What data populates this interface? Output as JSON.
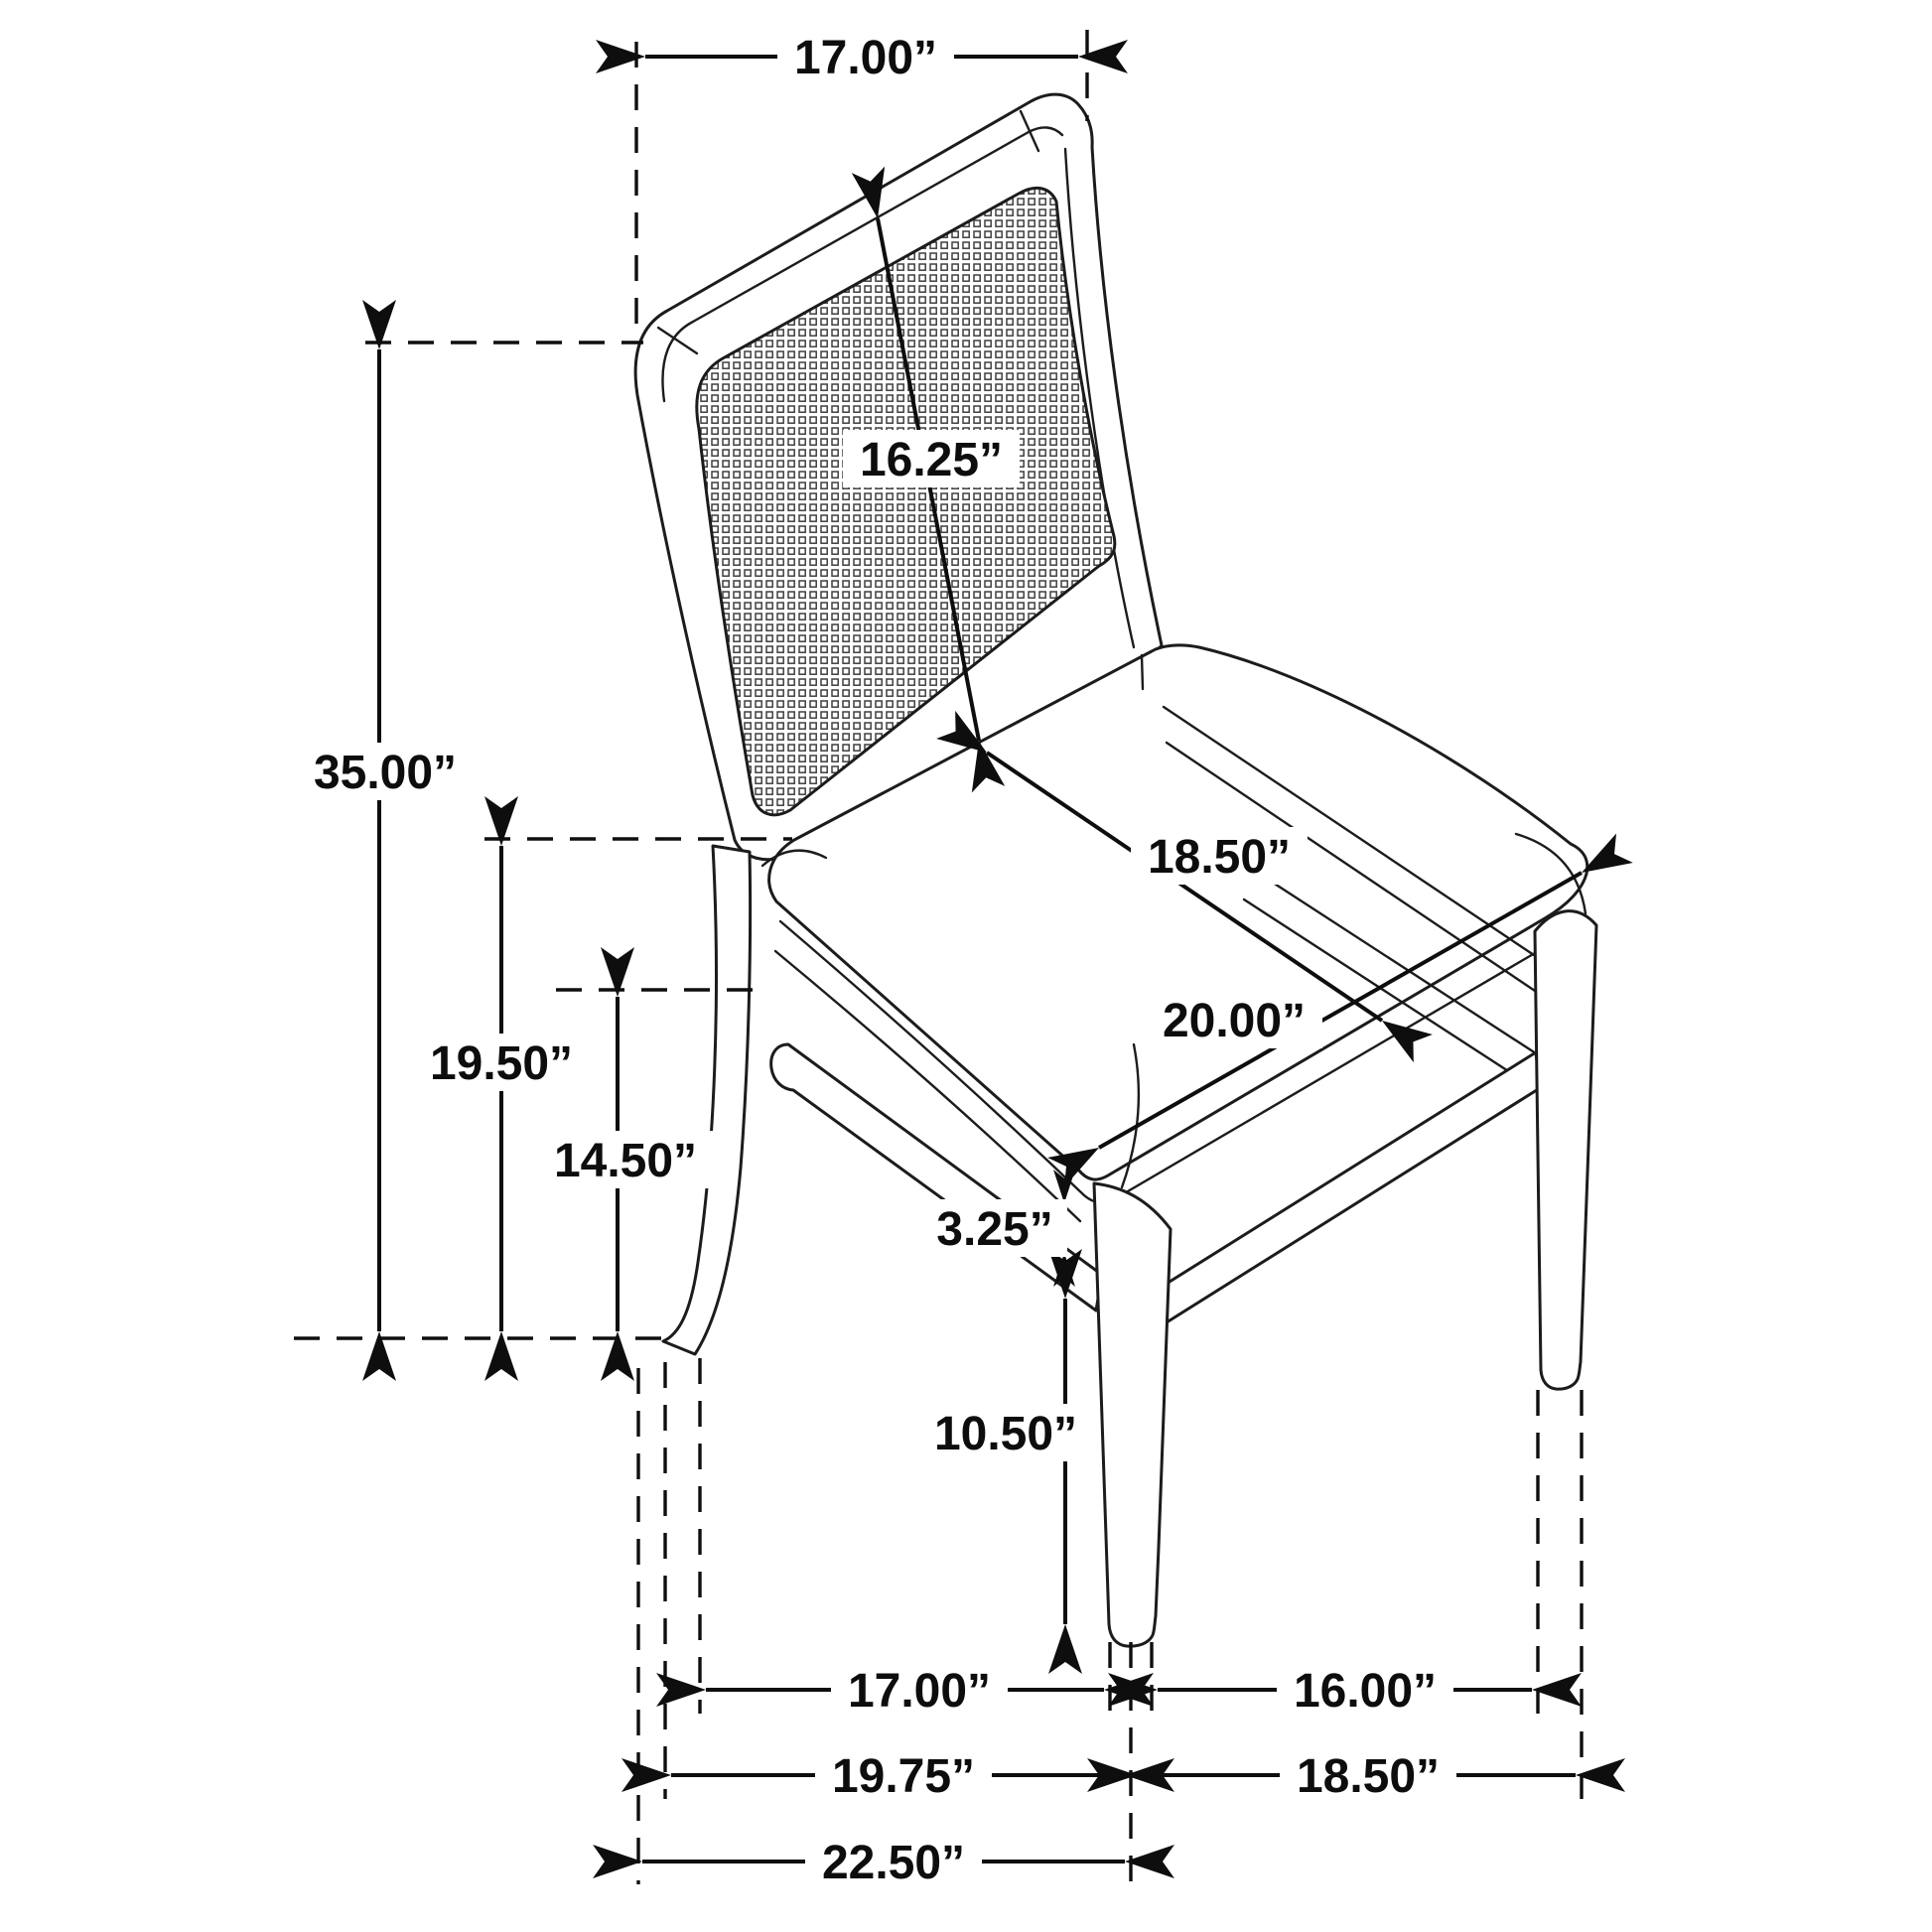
{
  "diagram": {
    "subject": "dining-chair-dimension-diagram",
    "units": "inches",
    "style": {
      "line_color": "#1c1c1c",
      "dimension_color": "#0e0e0e",
      "background": "#ffffff"
    },
    "measurements": {
      "back_top_width": {
        "label": "17.00”"
      },
      "back_panel_height": {
        "label": "16.25”"
      },
      "overall_height": {
        "label": "35.00”"
      },
      "seat_height": {
        "label": "19.50”"
      },
      "seat_frame_height": {
        "label": "14.50”"
      },
      "seat_depth": {
        "label": "18.50”"
      },
      "seat_width": {
        "label": "20.00”"
      },
      "stretcher_gap": {
        "label": "3.25”"
      },
      "leg_clearance": {
        "label": "10.50”"
      },
      "leg_span_side_inner": {
        "label": "17.00”"
      },
      "leg_span_front_inner": {
        "label": "16.00”"
      },
      "leg_span_side": {
        "label": "19.75”"
      },
      "leg_span_front": {
        "label": "18.50”"
      },
      "overall_depth": {
        "label": "22.50”"
      }
    }
  }
}
